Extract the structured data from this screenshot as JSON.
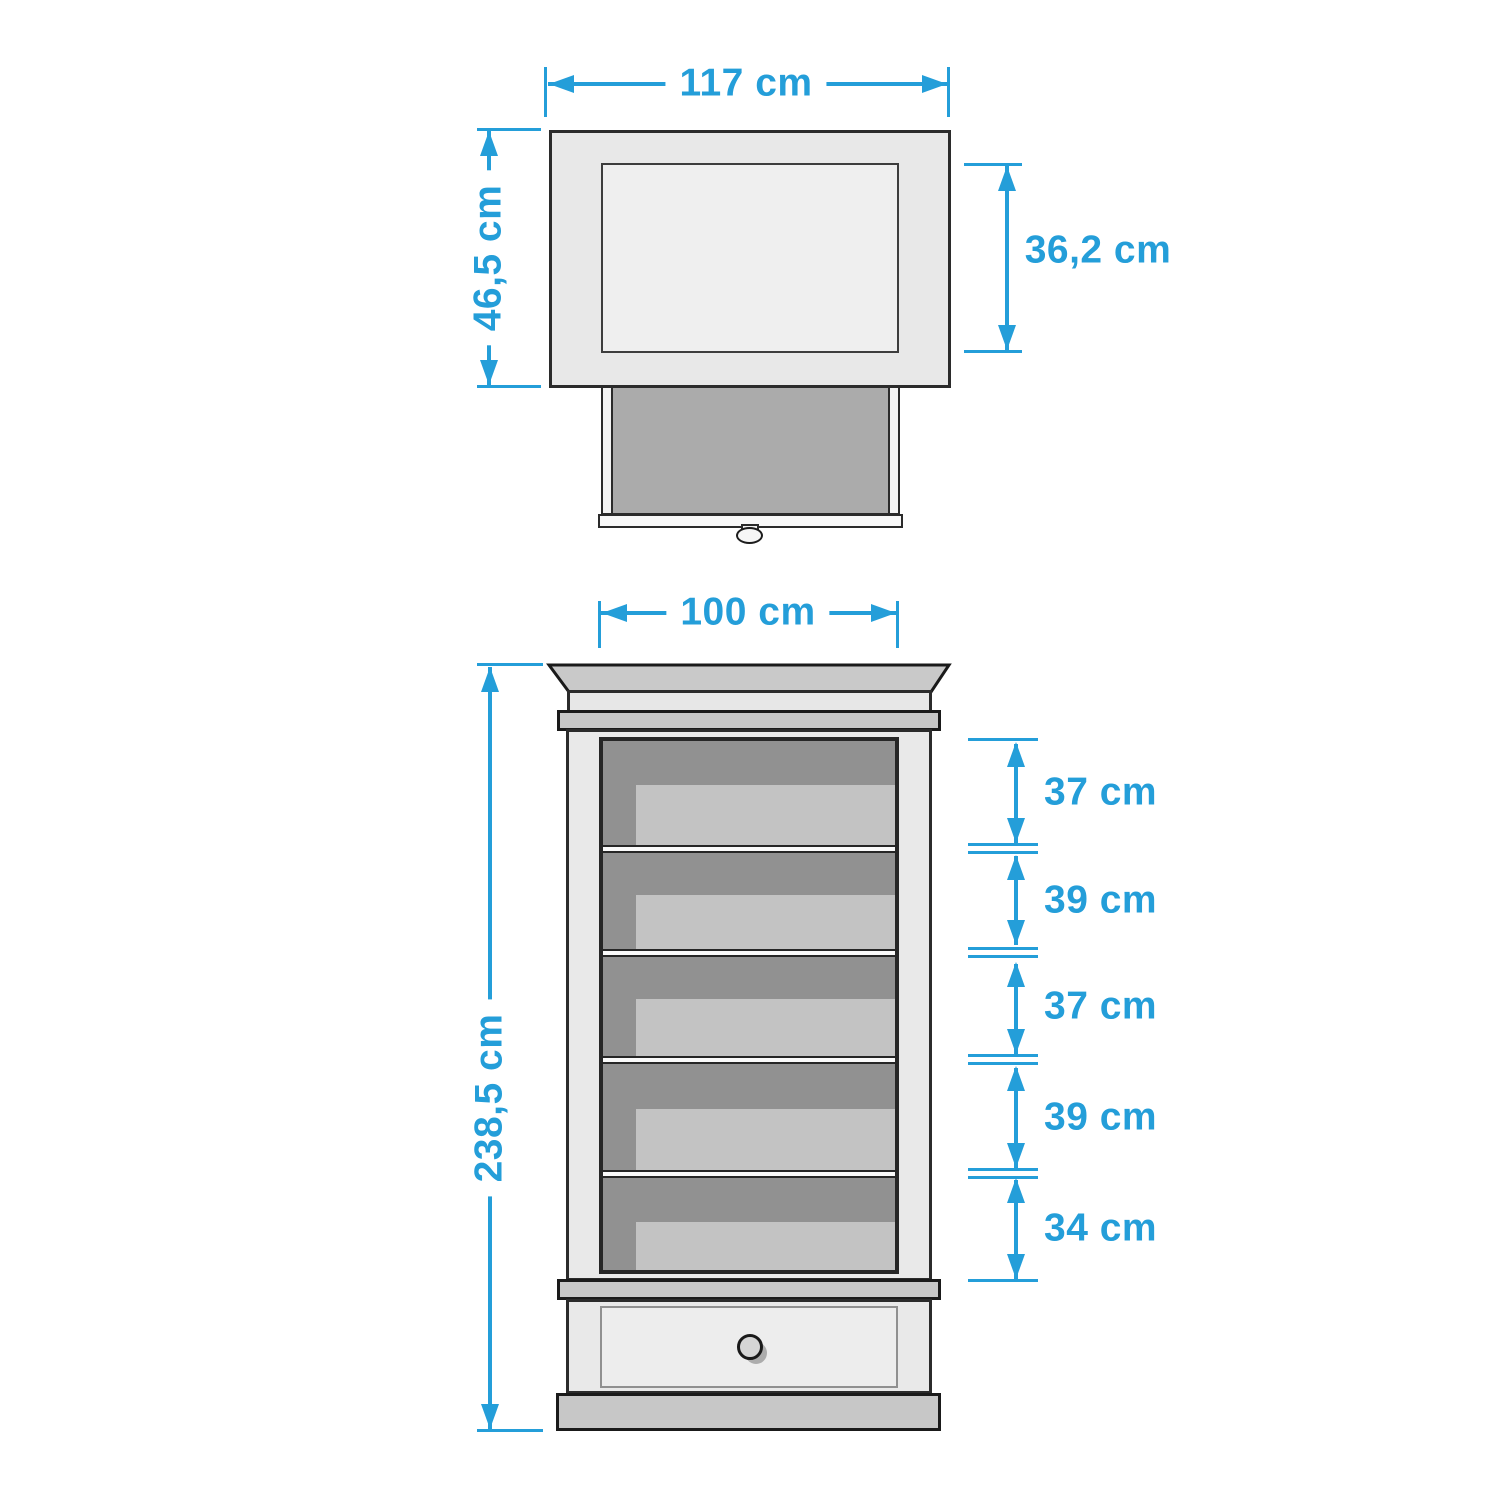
{
  "accent_color": "#249ed9",
  "top_view": {
    "width_label": "117 cm",
    "depth_label": "46,5 cm",
    "inner_depth_label": "36,2 cm"
  },
  "front_view": {
    "width_label": "100 cm",
    "height_label": "238,5 cm",
    "compartment_labels": [
      "37 cm",
      "39 cm",
      "37 cm",
      "39 cm",
      "34 cm"
    ]
  }
}
